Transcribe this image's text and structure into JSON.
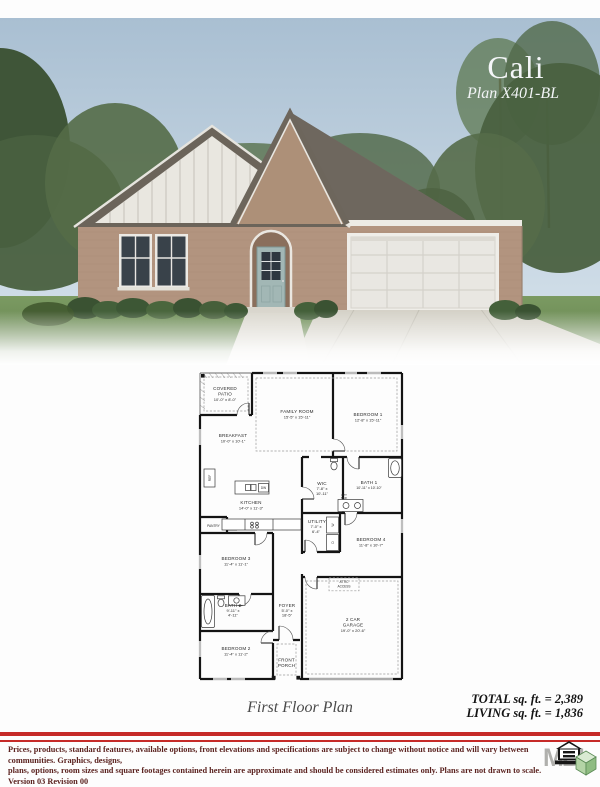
{
  "photo": {
    "plan_name": "Cali",
    "plan_code": "Plan X401-BL"
  },
  "floorplan": {
    "caption": "First Floor Plan",
    "rooms": {
      "covered_patio": {
        "l1": "COVERED",
        "l2": "PATIO",
        "dims": "10'-0\" x 8'-0\""
      },
      "family_room": {
        "name": "FAMILY ROOM",
        "dims": "15'-5\" x 15'-11\""
      },
      "bedroom1": {
        "name": "BEDROOM 1",
        "dims": "12'-8\" x 15'-11\""
      },
      "breakfast": {
        "name": "BREAKFAST",
        "dims": "10'-0\" x 10'-1\""
      },
      "kitchen": {
        "name": "KITCHEN",
        "dims": "14'-0\" x 11'-3\""
      },
      "wic": {
        "name": "WIC",
        "d1": "7'-8\" x",
        "d2": "10'-11\""
      },
      "bath1": {
        "name": "BATH 1",
        "dims": "10'-11\" x 10'-10\""
      },
      "utility": {
        "name": "UTILITY",
        "d1": "7'-0\" x",
        "d2": "6'-4\""
      },
      "bedroom4": {
        "name": "BEDROOM 4",
        "dims": "11'-8\" x 10'-7\""
      },
      "bedroom3": {
        "name": "BEDROOM 3",
        "dims": "11'-4\" x 11'-1\""
      },
      "bath2": {
        "name": "BATH 2",
        "d1": "9'-11\" x",
        "d2": "4'-11\""
      },
      "foyer": {
        "name": "FOYER",
        "d1": "5'-0\" x",
        "d2": "18'-5\""
      },
      "bedroom2": {
        "name": "BEDROOM 2",
        "dims": "11'-4\" x 11'-2\""
      },
      "garage": {
        "l1": "2 CAR",
        "l2": "GARAGE",
        "dims": "19'-0\" x 20'-6\""
      },
      "front_porch": {
        "l1": "FRONT",
        "l2": "PORCH"
      },
      "attic": {
        "l1": "ATTIC",
        "l2": "ACCESS"
      },
      "pantry": "PANTRY",
      "ref": "REF",
      "dw": "DW",
      "opt_sink_1": "OPT",
      "opt_sink_2": "SINK",
      "washer": "W",
      "dryer": "D"
    }
  },
  "summary": {
    "total": "TOTAL sq. ft. = 2,389",
    "living": "LIVING sq. ft. = 1,836"
  },
  "disclaimer": {
    "line1": "Prices, products, standard features, available options, front elevations and specifications are subject to change without notice and will vary between communities.  Graphics, designs,",
    "line2": "plans, options, room sizes and square footages contained herein are approximate and should be considered estimates only.  Plans are not drawn to scale.    Version 03 Revision 00",
    "colors": {
      "accent_red": "#c62a28",
      "text": "#5b2320"
    }
  },
  "logo": {
    "letters": "MBI"
  }
}
